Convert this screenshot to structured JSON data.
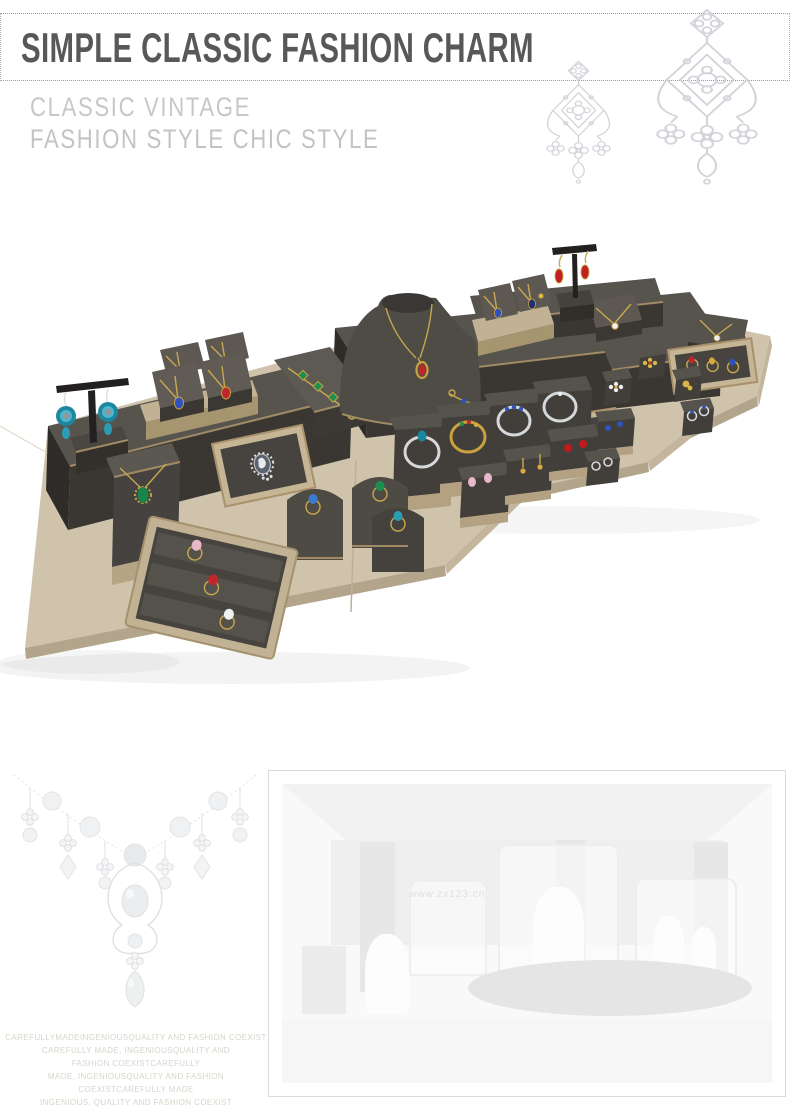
{
  "header": {
    "title": "SIMPLE CLASSIC FASHION CHARM",
    "subtitle_line1": "CLASSIC VINTAGE",
    "subtitle_line2": "FASHION STYLE CHIC STYLE",
    "title_color": "#58585a",
    "subtitle_color": "#c7c7c9",
    "rule_style": "dotted"
  },
  "decor": {
    "ornament_large": "chandelier-pendant-line-art",
    "ornament_small": "chandelier-pendant-line-art-small"
  },
  "product_photo": {
    "description": "Jewelry display prop set: dark taupe microfiber stands with champagne gold trim arranged on beige linen boards, holding necklaces, pendants, bangles, rings, brooch and earrings",
    "items": [
      "earring T-stand with teal chandelier earrings",
      "necklace bust with red pendant",
      "pendant wedges",
      "cameo brooch tray",
      "bracelet bar",
      "bangle stands",
      "ring humps",
      "three-slot ring tray",
      "stud earring blocks",
      "flower ring blocks",
      "trio ring tray",
      "red drop earring T-stand"
    ],
    "palette": {
      "base_linen": "#cfc3ac",
      "base_edge": "#b2a58c",
      "display_top": "#57534d",
      "display_front": "#3a3733",
      "gold_trim": "#a08b64",
      "chain_gold": "#c8a84f",
      "background": "#ffffff"
    },
    "gem_colors": [
      "#c0272d",
      "#2f52bb",
      "#18889e",
      "#1f8f4d",
      "#c9a23f",
      "#e8b7ca",
      "#eef0f2",
      "#1f2e7a"
    ]
  },
  "bottom": {
    "necklace_art": "faded-pearl-diamond-necklace",
    "store_photo": {
      "frame": "thin-gray-border",
      "scene": "faded jewelry boutique interior with glass display cases",
      "watermark": "www.zx123.cn"
    },
    "footer_lines": [
      "CAREFULLYMADEINGENIOUSQUALITY AND FASHION COEXIST",
      "CAREFULLY MADE, INGENIOUSQUALITY AND",
      "FASHION COEXISTCAREFULLY",
      "MADE, INGENIOUSQUALITY AND FASHION COEXISTCAREFULLY MADE",
      "INGENIOUS, QUALITY AND FASHION COEXIST"
    ]
  }
}
